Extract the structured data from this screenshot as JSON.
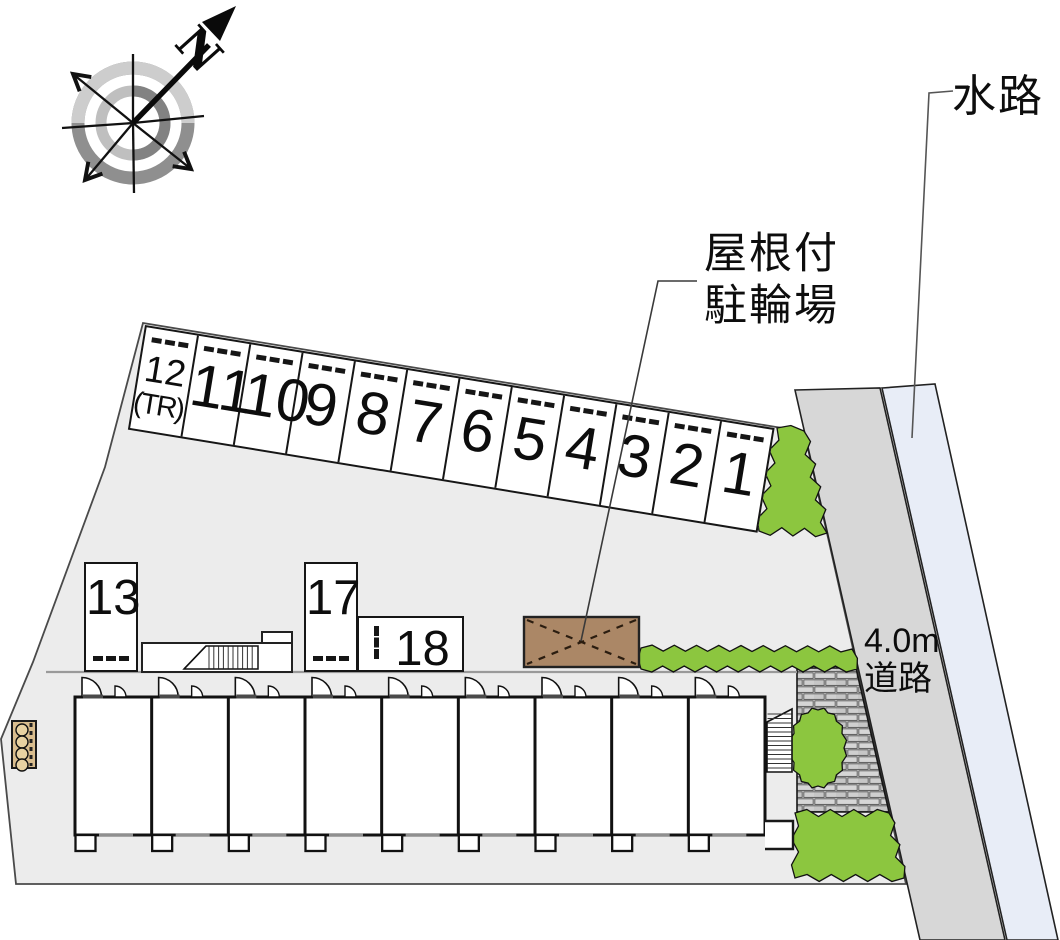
{
  "compass": {
    "north": "N"
  },
  "labels": {
    "waterway": "水路",
    "bicycle_line1": "屋根付",
    "bicycle_line2": "駐輪場",
    "road_line1": "4.0m",
    "road_line2": "道路"
  },
  "parking_row": [
    {
      "label": "12",
      "sub": "(TR)"
    },
    {
      "label": "11"
    },
    {
      "label": "10"
    },
    {
      "label": "9"
    },
    {
      "label": "8"
    },
    {
      "label": "7"
    },
    {
      "label": "6"
    },
    {
      "label": "5"
    },
    {
      "label": "4"
    },
    {
      "label": "3"
    },
    {
      "label": "2"
    },
    {
      "label": "1"
    }
  ],
  "standalone_stalls": {
    "s13": "13",
    "s17": "17",
    "s18": "18"
  },
  "colors": {
    "site": "#ececec",
    "road": "#d7d7d7",
    "waterway": "#e8edf7",
    "hedge": "#8cc63f",
    "shed": "#ab8766",
    "planter": "#d9bd8e",
    "line": "#161616"
  }
}
